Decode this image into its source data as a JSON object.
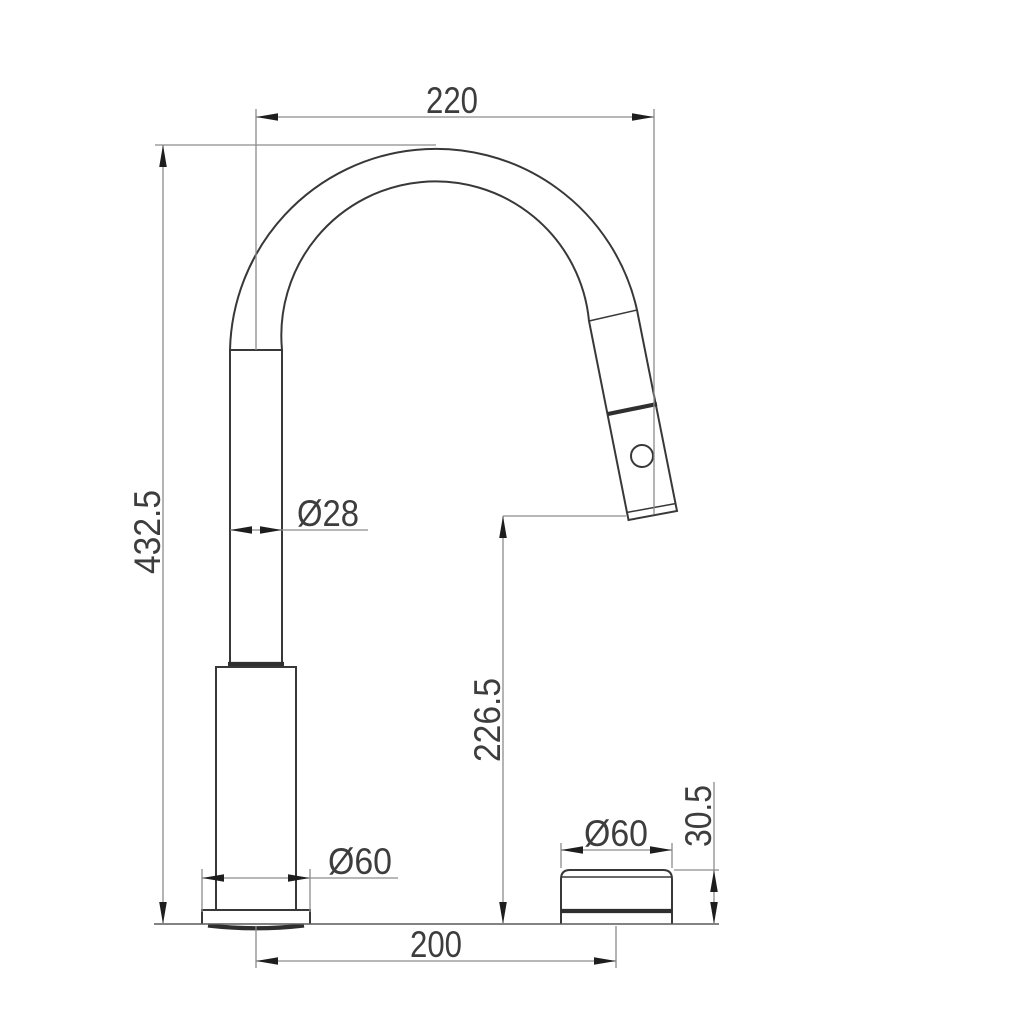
{
  "drawing": {
    "dimensions": {
      "spout_reach": "220",
      "overall_height": "432.5",
      "pipe_diameter": "Ø28",
      "outlet_height": "226.5",
      "base_diameter": "Ø60",
      "knob_diameter": "Ø60",
      "knob_height": "30.5",
      "hole_spacing": "200"
    },
    "icons": {
      "spray_button": "circle-outline"
    },
    "colors": {
      "background": "#ffffff",
      "object_line": "#383838",
      "dimension_line": "#8c8c8c",
      "arrow_fill": "#1e1e1e",
      "label_text": "#3d3d3d"
    }
  }
}
